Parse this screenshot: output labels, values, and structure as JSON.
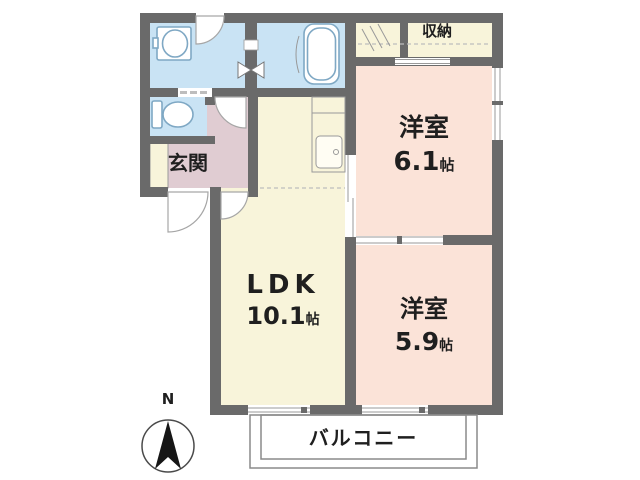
{
  "rooms": {
    "ldk": {
      "label": "LDK",
      "area": "10.1",
      "unit": "帖"
    },
    "western_6_1": {
      "label": "洋室",
      "area": "6.1",
      "unit": "帖"
    },
    "western_5_9": {
      "label": "洋室",
      "area": "5.9",
      "unit": "帖"
    },
    "entrance": {
      "label": "玄関"
    },
    "storage": {
      "label": "収納"
    },
    "balcony": {
      "label": "バルコニー"
    }
  },
  "compass": {
    "north_label": "N"
  },
  "fixtures": [
    "bathtub-icon",
    "washbasin-icon",
    "toilet-icon",
    "kitchen-sink-icon",
    "hanger-pipe-icon"
  ],
  "colors": {
    "wall": "#6a6a6a",
    "wet_area": "#c9e3f4",
    "living_kitchen": "#f8f4da",
    "bedroom": "#fbe3d8",
    "entrance_hall": "#e0ccd2",
    "background": "#ffffff"
  }
}
